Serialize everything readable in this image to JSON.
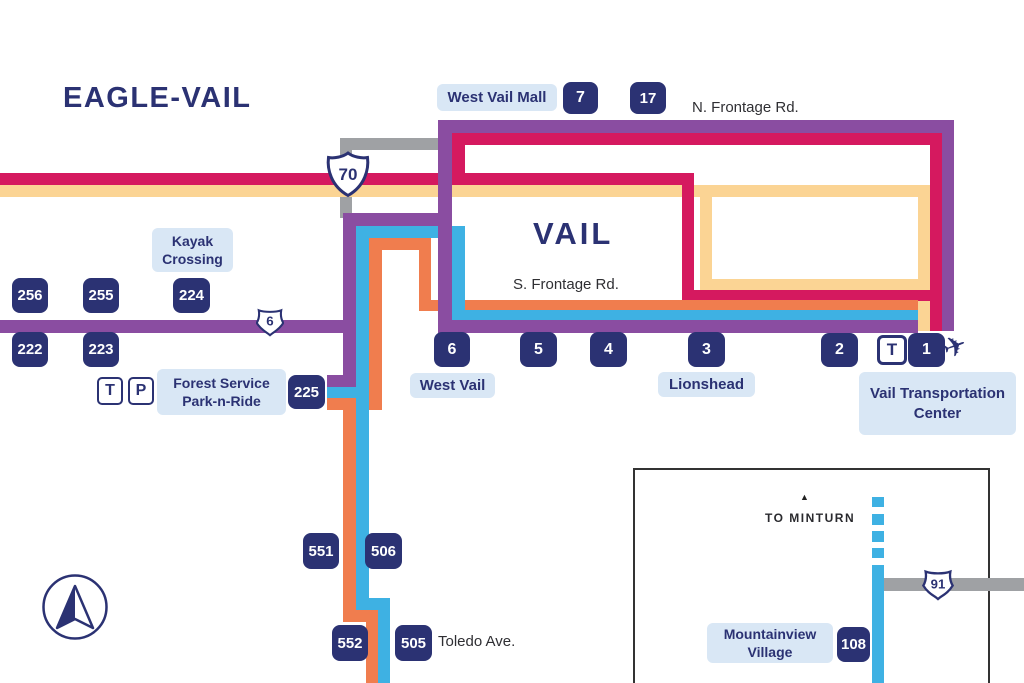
{
  "colors": {
    "navy": "#2b3273",
    "purple": "#8a4da1",
    "pink": "#d5195f",
    "yellow": "#fbd494",
    "orange": "#f07d4e",
    "blue": "#3eb1e3",
    "road_gray": "#9fa1a4",
    "label_bg": "#d9e7f5"
  },
  "titles": {
    "eagle_vail": "EAGLE-VAIL",
    "vail": "VAIL"
  },
  "roads": {
    "n_frontage": "N. Frontage Rd.",
    "s_frontage": "S. Frontage Rd.",
    "toledo": "Toledo Ave.",
    "to_minturn": "TO MINTURN"
  },
  "shields": {
    "i70": "70",
    "route6": "6",
    "us91": "91"
  },
  "stops": {
    "s7": "7",
    "s17": "17",
    "s256": "256",
    "s255": "255",
    "s224": "224",
    "s222": "222",
    "s223": "223",
    "s225": "225",
    "s6": "6",
    "s5": "5",
    "s4": "4",
    "s3": "3",
    "s2": "2",
    "sT": "T",
    "s1": "1",
    "s551": "551",
    "s506": "506",
    "s552": "552",
    "s505": "505",
    "s108": "108"
  },
  "park_n_ride": {
    "transit": "T",
    "parking": "P"
  },
  "labels": {
    "west_vail_mall": "West Vail Mall",
    "kayak_crossing": "Kayak Crossing",
    "forest_service": "Forest Service Park-n-Ride",
    "west_vail": "West Vail",
    "lionshead": "Lionshead",
    "vail_transportation_center": "Vail Transportation Center",
    "mountainview_village": "Mountainview Village"
  },
  "icons": {
    "airplane": "✈",
    "minturn_arrow": "▲"
  }
}
